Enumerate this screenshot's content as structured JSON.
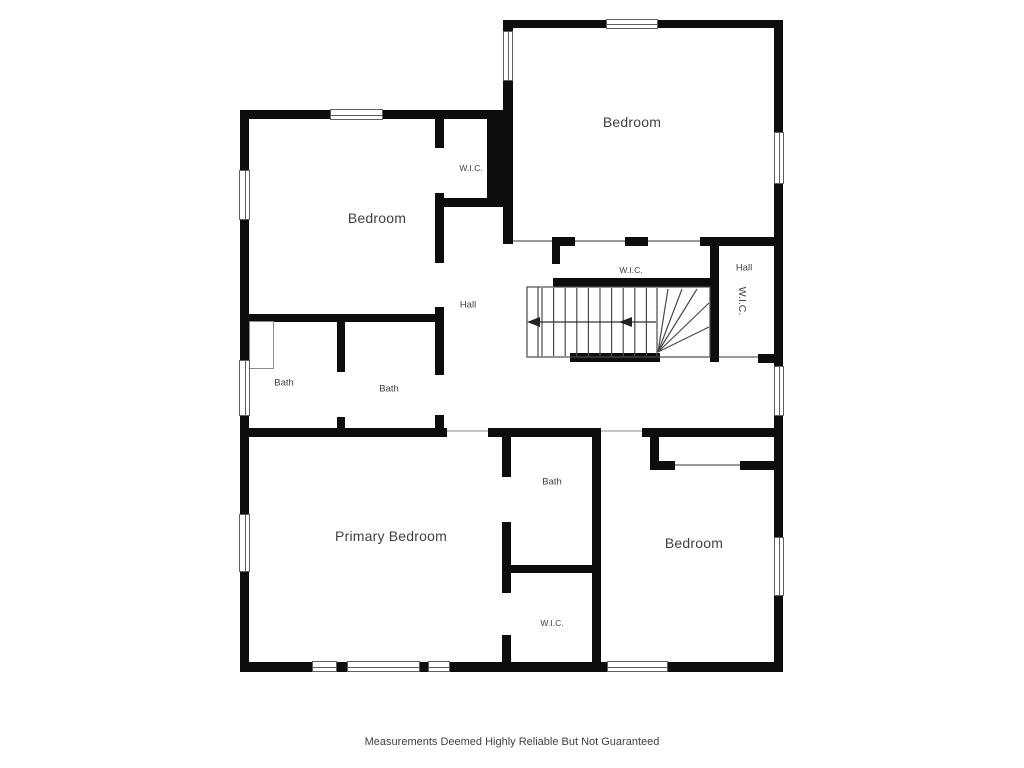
{
  "floorplan": {
    "colors": {
      "wall": "#0d0d0d",
      "text": "#3f3f46",
      "stair_line": "#4a4a4a",
      "window_frame": "#606060",
      "door_line": "#c4c4c4",
      "opening_line": "#9a9a9a"
    },
    "rooms": {
      "bedroom_top_left": {
        "label": "Bedroom"
      },
      "bedroom_top_right": {
        "label": "Bedroom"
      },
      "primary_bedroom": {
        "label": "Primary Bedroom"
      },
      "bedroom_bottom_right": {
        "label": "Bedroom"
      },
      "bath_left": {
        "label": "Bath"
      },
      "bath_middle": {
        "label": "Bath"
      },
      "bath_lower": {
        "label": "Bath"
      },
      "wic_top_left": {
        "label": "W.I.C."
      },
      "wic_middle": {
        "label": "W.I.C."
      },
      "wic_right": {
        "label": "W.I.C."
      },
      "wic_lower": {
        "label": "W.I.C."
      },
      "hall_left": {
        "label": "Hall"
      },
      "hall_right": {
        "label": "Hall"
      }
    },
    "footer": {
      "disclaimer": "Measurements Deemed Highly Reliable But Not Guaranteed"
    }
  }
}
